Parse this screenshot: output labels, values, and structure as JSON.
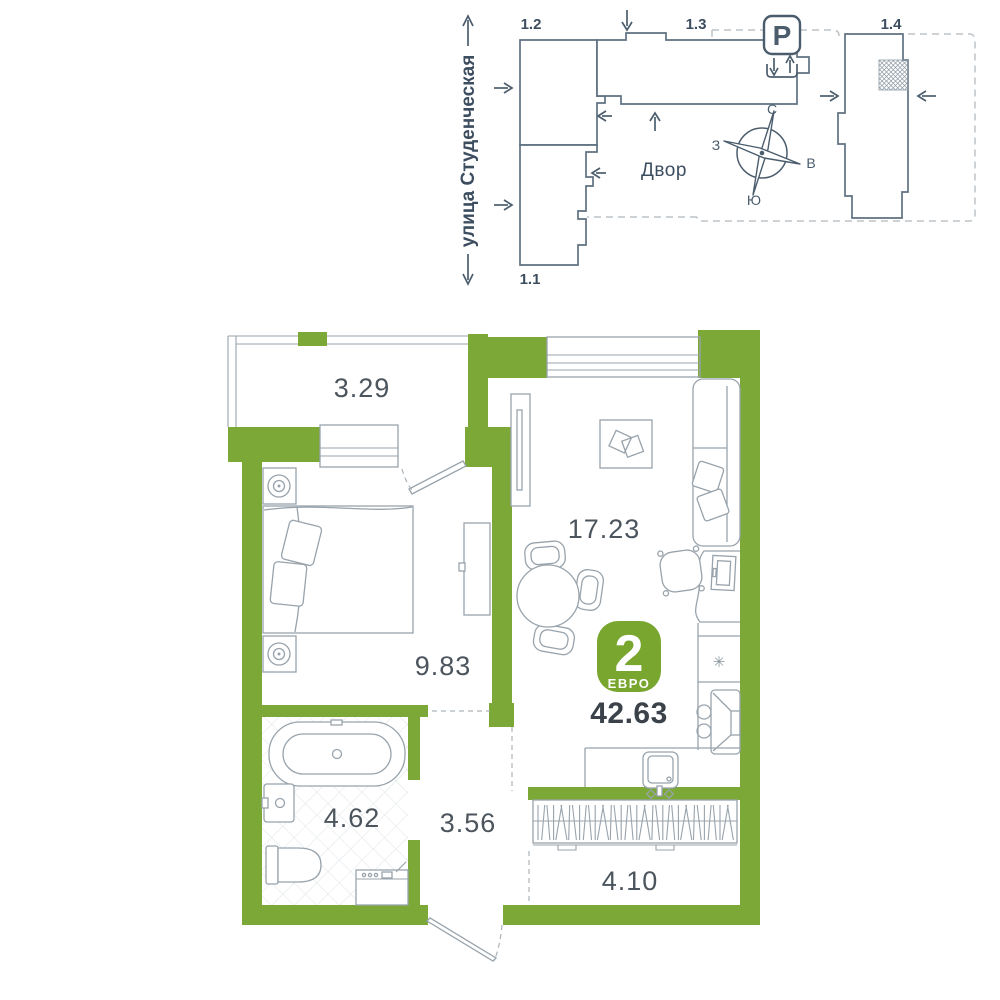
{
  "site_plan": {
    "street_label": "улица Студенческая",
    "courtyard_label": "Двор",
    "parking_symbol": "P",
    "building_labels": {
      "b11": "1.1",
      "b12": "1.2",
      "b13": "1.3",
      "b14": "1.4"
    },
    "compass": {
      "north": "С",
      "south": "Ю",
      "west": "З",
      "east": "В"
    }
  },
  "floor_plan": {
    "badge": {
      "rooms_count": "2",
      "type_label": "ЕВРО"
    },
    "total_area": "42.63",
    "room_areas": {
      "balcony": "3.29",
      "living_kitchen": "17.23",
      "bedroom": "9.83",
      "bathroom": "4.62",
      "hallway": "3.56",
      "wardrobe": "4.10"
    }
  },
  "icons": {
    "snowflake": "✳",
    "parking": "P"
  },
  "colors": {
    "wall_green": "#7CA837",
    "badge_green": "#78A62F",
    "furniture_line": "#98A3AC",
    "site_line": "#5F7181",
    "text_dark": "#3B4249",
    "label_gray": "#4C555D",
    "dashed_gray": "#BCC3C8"
  }
}
